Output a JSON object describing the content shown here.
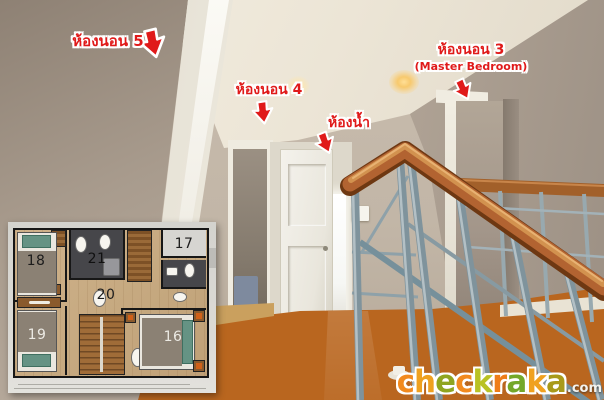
{
  "annotations": {
    "text_color": "#e01a1a",
    "outline_color": "#ffffff",
    "labels": [
      {
        "id": "bedroom-5",
        "text": "ห้องนอน 5"
      },
      {
        "id": "bedroom-4",
        "text": "ห้องนอน 4"
      },
      {
        "id": "bathroom",
        "text": "ห้องน้ำ"
      },
      {
        "id": "bedroom-3",
        "text": "ห้องนอน 3",
        "subtext": "(Master Bedroom)"
      }
    ],
    "arrow_icon": "red-arrow",
    "arrow_color": "#e01a1a"
  },
  "floorplan": {
    "rooms": [
      {
        "number": "16"
      },
      {
        "number": "17"
      },
      {
        "number": "18"
      },
      {
        "number": "19"
      },
      {
        "number": "20"
      },
      {
        "number": "21"
      }
    ]
  },
  "watermark": {
    "letters": [
      "c",
      "h",
      "e",
      "c",
      "k",
      "r",
      "a",
      "k",
      "a"
    ],
    "suffix": ".com",
    "letter_colors": [
      "#f28a1e",
      "#efa11f",
      "#8fa51f",
      "#f28a1e",
      "#b9c224",
      "#ef7d18",
      "#74a829",
      "#f0a11f",
      "#a89a1a"
    ]
  },
  "palette": {
    "wall": "#b9ab9d",
    "ceiling": "#efe9dc",
    "door_white": "#f3f1ea",
    "floor_wood": "#c06a28",
    "handrail_wood": "#b26331",
    "steel_baluster": "#8fa3ab",
    "plan_tile": "#46464a",
    "plan_wood": "#c9ad85"
  }
}
